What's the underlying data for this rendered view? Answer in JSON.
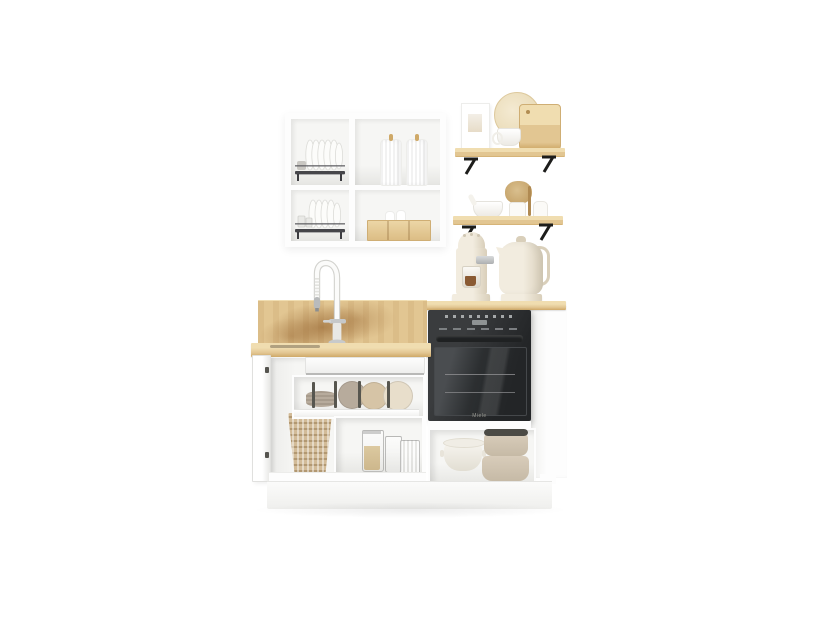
{
  "meta": {
    "type": "product-photo",
    "subject": "Compact modular kitchen set: white open wall cabinet with dish racks, two oak wall shelves, cream espresso machine and kettle, oak worktop with gooseneck faucet and backsplash, white base units with open drawers, built-in black oven and pot drawer"
  },
  "palette": {
    "bg": "#ffffff",
    "white": "#fdfdfd",
    "white-shade": "#efefed",
    "edge": "#e3e3e1",
    "interior": "#f6f6f4",
    "interior-dark": "#e6e6e3",
    "wood-hi": "#f0ddb0",
    "wood": "#e2c692",
    "wood-deep": "#cfa968",
    "stain": "#8f5c28",
    "rack": "#46464a",
    "metal-black": "#1d1d1b",
    "oven-shell": "#3a3c3e",
    "oven-dark": "#232527",
    "oven-glass-hi": "#4a4d50",
    "cream": "#f2ecdf",
    "cream-dk": "#d9cfba",
    "chrome": "#c9cbcc",
    "basket": "#d2bb98",
    "plate-gray": "#b7ab9c",
    "plate-beige": "#d6c4a6",
    "plate-cream": "#e8decb",
    "grain": "#dcc9a0",
    "pot-beige": "#d8ccba",
    "pot-lid": "#4b4a45",
    "coffee": "#8a5a33",
    "shadow": "rgba(0,0,0,.07)"
  },
  "labels": {
    "oven_brand": "Miele"
  },
  "objects": {
    "wall_cabinet": {
      "name": "open wall cabinet",
      "compartments": [
        "wire dish rack with plates",
        "wire dish rack with plates and glasses",
        "two embossed ceramic canisters",
        "wooden crate with shakers"
      ]
    },
    "shelves": [
      {
        "name": "upper oak shelf",
        "items": [
          "picture frame",
          "round cutting board",
          "rectangular cutting board",
          "coffee cup"
        ]
      },
      {
        "name": "lower oak shelf",
        "items": [
          "mortar and pestle",
          "dried flowers in vase",
          "small bottles"
        ]
      }
    ],
    "countertop_appliances": [
      "cream espresso machine with glass carafe",
      "cream electric kettle"
    ],
    "sink_unit": [
      "white gooseneck faucet",
      "oak backsplash",
      "open hinged door",
      "wicker basket",
      "open top drawer",
      "plate drawer with peg dividers",
      "glass jars with grains"
    ],
    "oven_unit": [
      "black built-in oven",
      "open pot drawer with cookware"
    ]
  }
}
